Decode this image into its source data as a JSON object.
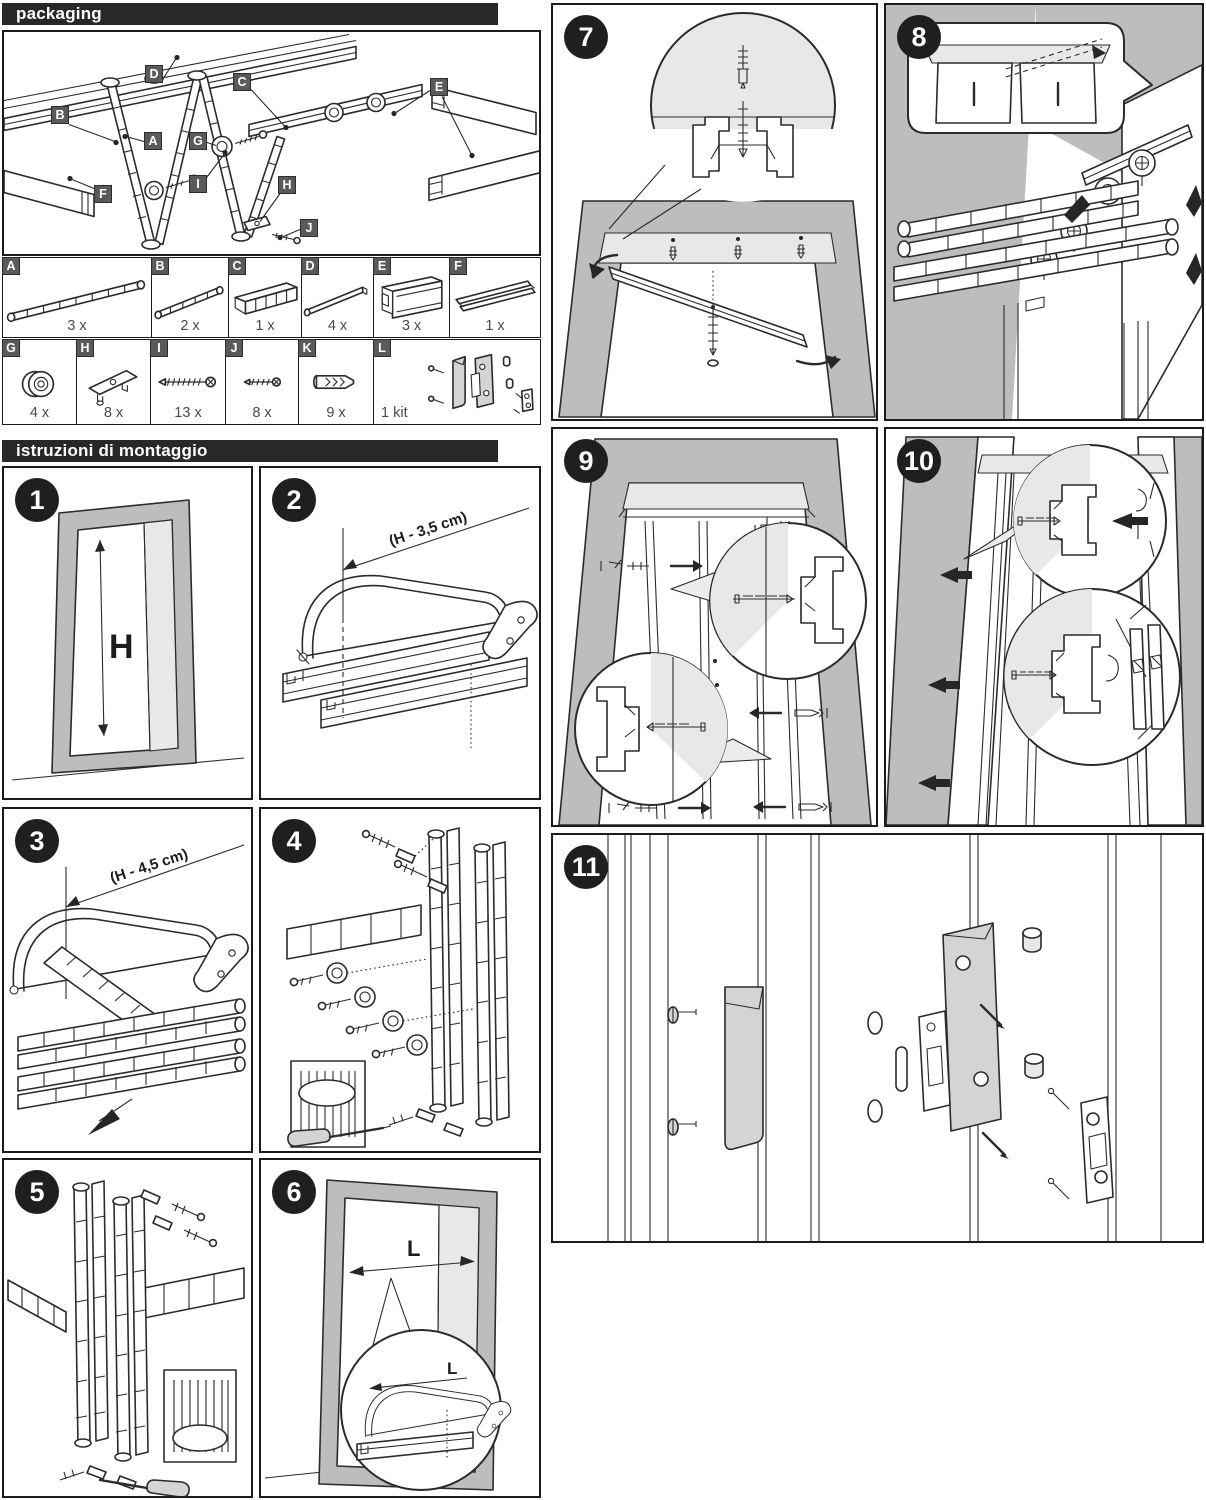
{
  "packaging": {
    "title": "packaging",
    "callouts": [
      "A",
      "B",
      "C",
      "D",
      "E",
      "F",
      "G",
      "H",
      "I",
      "J"
    ]
  },
  "parts": {
    "row1": [
      {
        "letter": "A",
        "count": "3 x",
        "icon": "slat-panel-long"
      },
      {
        "letter": "B",
        "count": "2 x",
        "icon": "slat-panel-short"
      },
      {
        "letter": "C",
        "count": "1 x",
        "icon": "carrier-panel"
      },
      {
        "letter": "D",
        "count": "4 x",
        "icon": "thin-profile"
      },
      {
        "letter": "E",
        "count": "3 x",
        "icon": "track-profile"
      },
      {
        "letter": "F",
        "count": "1 x",
        "icon": "edge-profile"
      }
    ],
    "row2": [
      {
        "letter": "G",
        "count": "4 x",
        "icon": "roller"
      },
      {
        "letter": "H",
        "count": "8 x",
        "icon": "bracket"
      },
      {
        "letter": "I",
        "count": "13 x",
        "icon": "long-screw"
      },
      {
        "letter": "J",
        "count": "8 x",
        "icon": "short-screw"
      },
      {
        "letter": "K",
        "count": "9 x",
        "icon": "wall-plug"
      },
      {
        "letter": "L",
        "count": "1 kit",
        "icon": "handle-latch-kit"
      }
    ]
  },
  "instructions": {
    "title": "istruzioni di montaggio",
    "steps": {
      "s1": {
        "num": "1",
        "dim": "H"
      },
      "s2": {
        "num": "2",
        "dim": "(H - 3,5 cm)"
      },
      "s3": {
        "num": "3",
        "dim": "(H - 4,5 cm)"
      },
      "s4": {
        "num": "4"
      },
      "s5": {
        "num": "5"
      },
      "s6": {
        "num": "6",
        "dim": "L",
        "inset_dim": "L"
      },
      "s7": {
        "num": "7"
      },
      "s8": {
        "num": "8"
      },
      "s9": {
        "num": "9"
      },
      "s10": {
        "num": "10"
      },
      "s11": {
        "num": "11"
      }
    }
  }
}
